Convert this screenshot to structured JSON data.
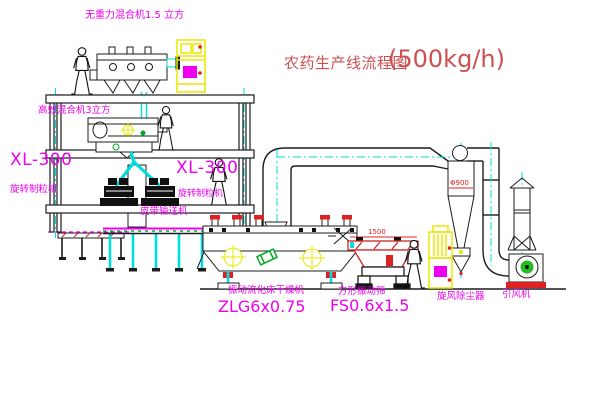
{
  "title": {
    "name": "农药生产线流程图",
    "capacity": "(500kg/h)"
  },
  "labels": {
    "gravity_mixer": "无重力混合机1.5 立方",
    "high_mixer": "高效混合机3立方",
    "granulator_left_model": "XL-300",
    "granulator_left_name": "旋转制粒机",
    "granulator_mid_model": "XL-300",
    "granulator_mid_name": "旋转制粒机",
    "belt_conveyor": "皮带输送机",
    "dryer_name": "振动流化床干燥机",
    "dryer_model": "ZLG6x0.75",
    "sieve_name": "方形振动筛",
    "sieve_model": "FS0.6x1.5",
    "cyclone": "旋风除尘器",
    "fan": "引风机"
  },
  "dimensions": {
    "sieve_width": "1500",
    "cyclone_diameter": "Φ900"
  },
  "colors": {
    "label_magenta": "#ee00ee",
    "title_red": "#cc5050",
    "dimension_red": "#e02020",
    "centerline_cyan": "#00dddd",
    "cabinet_yellow": "#e8e800",
    "machine_green": "#00aa22",
    "line_black": "#1c1c1c",
    "background": "#ffffff"
  }
}
